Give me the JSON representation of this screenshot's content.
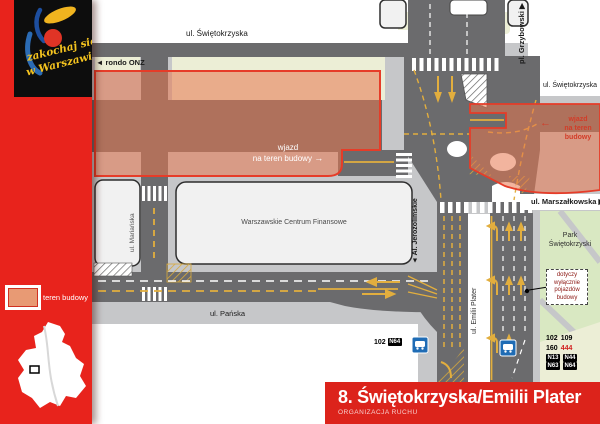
{
  "colors": {
    "accent_red": "#e8231c",
    "construction_fill": "rgba(232,118,78,0.55)",
    "construction_border": "#e63c28",
    "park_green": "#d9e8c2",
    "road_gray": "#6b6b6d",
    "pavement_gray": "#c6c7c9",
    "sidewalk_cream": "#eceed6",
    "bus_blue": "#1f6cb5"
  },
  "sidebar": {
    "logo": {
      "line1": "zakochaj się",
      "line2": "w Warszawie"
    },
    "legend_label": "teren budowy"
  },
  "title_bar": {
    "title": "8. Świętokrzyska/Emilii Plater",
    "subtitle": "ORGANIZACJA RUCHU"
  },
  "map": {
    "street_labels": {
      "swietokrzyska_top": "ul. Świętokrzyska",
      "swietokrzyska_east": "ul. Świętokrzyska",
      "rondo_onz": "◄ rondo ONZ",
      "pl_grzybowski": "pl. Grzybowski ▶",
      "marszalkowska": "ul. Marszałkowska ▶",
      "marianska": "ul. Mariańska",
      "al_jerozolimskie": "◄ Al. Jerozolimskie",
      "emilii_plater": "ul. Emilii Plater",
      "panska": "ul. Pańska"
    },
    "park": {
      "line1": "Park",
      "line2": "Świętokrzyski"
    },
    "building_wcf": "Warszawskie Centrum Finansowe",
    "wjazd_west": {
      "line1": "wjazd",
      "line2": "na teren budowy",
      "arrow": "→"
    },
    "wjazd_east": {
      "arrow": "←",
      "line1": "wjazd",
      "line2": "na teren",
      "line3": "budowy"
    },
    "notice": {
      "line1": "dotyczy",
      "line2": "wyłącznie",
      "line3": "pojazdów",
      "line4": "budowy"
    },
    "bus_stop_west": {
      "line": "102",
      "night_badge": "N64"
    },
    "bus_stop_east": {
      "row1": [
        "102",
        "109"
      ],
      "row2_day": "160",
      "row2_red": "444",
      "row3": [
        "N13",
        "N44"
      ],
      "row4": [
        "N63",
        "N64"
      ]
    }
  }
}
